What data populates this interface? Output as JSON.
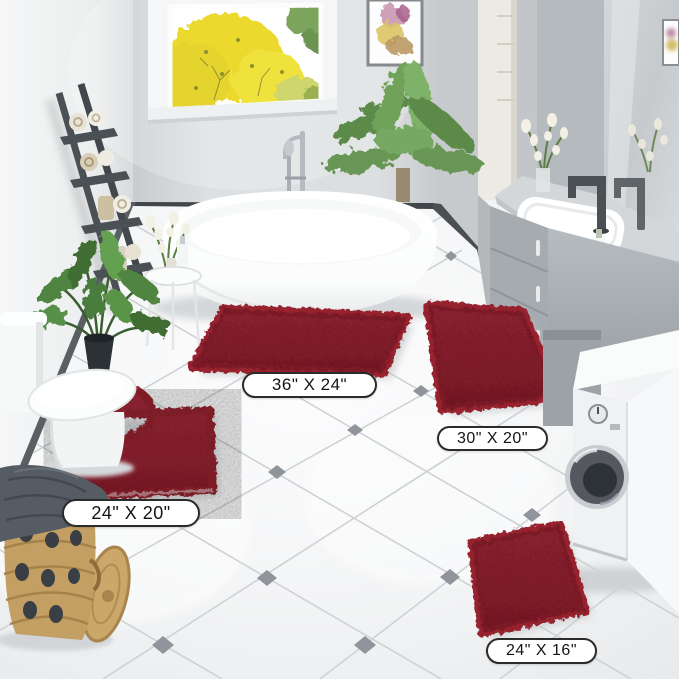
{
  "labels": [
    {
      "id": "rug-36x24",
      "text": "36\" X 24\""
    },
    {
      "id": "rug-30x20",
      "text": "30\" X 20\""
    },
    {
      "id": "rug-24x20",
      "text": "24\" X 20\""
    },
    {
      "id": "rug-24x16",
      "text": "24\" X 16\""
    }
  ],
  "colors": {
    "rug_red": "#9b2334",
    "rug_red_dark": "#7c1626",
    "floor_line": "#cfd2d5",
    "floor_diamond": "#8f959b",
    "wall_gray": "#d9dcde",
    "label_border": "#2b2b2b",
    "label_bg": "#ffffff",
    "label_text": "#141414"
  }
}
